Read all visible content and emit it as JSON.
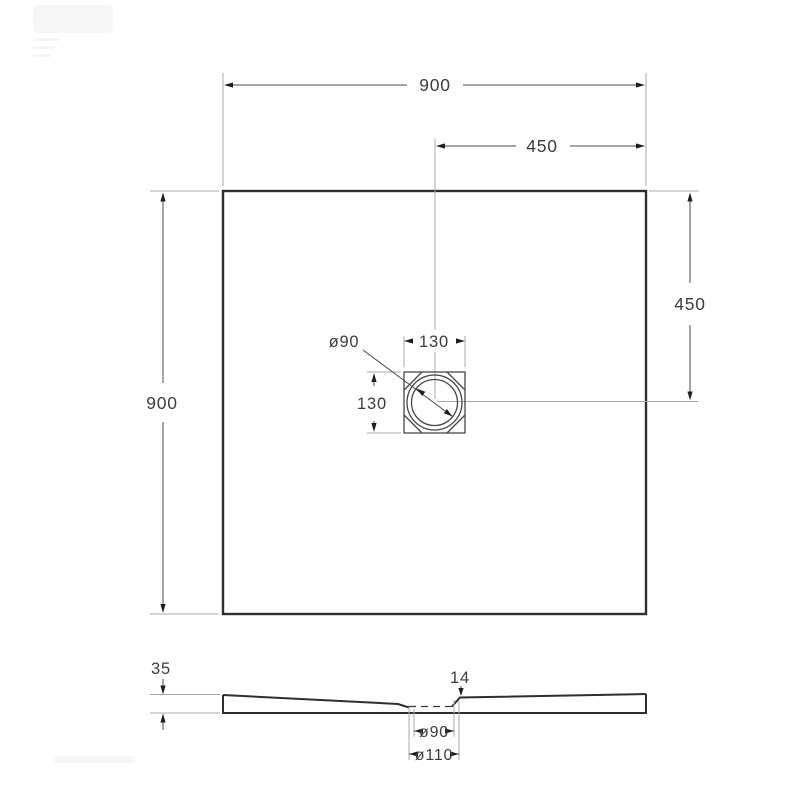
{
  "drawing": {
    "kind": "technical-drawing",
    "subject": "square shower tray - plan view and section view",
    "colors": {
      "background": "#ffffff",
      "outline": "#2e2e2e",
      "dimension_line": "#4a4a4a",
      "extension_line": "#a8a8a8",
      "text": "#3d3d3d"
    },
    "top_view": {
      "overall_width_label": "900",
      "overall_height_label": "900",
      "center_offset_top_label": "450",
      "center_offset_right_label": "450",
      "drain_box_width_label": "130",
      "drain_box_height_label": "130",
      "drain_diameter_label": "ø90"
    },
    "section_view": {
      "edge_thickness_label": "35",
      "drain_zone_thickness_label": "14",
      "drain_hole_diameter_label": "ø90",
      "waste_outlet_diameter_label": "ø110"
    }
  }
}
